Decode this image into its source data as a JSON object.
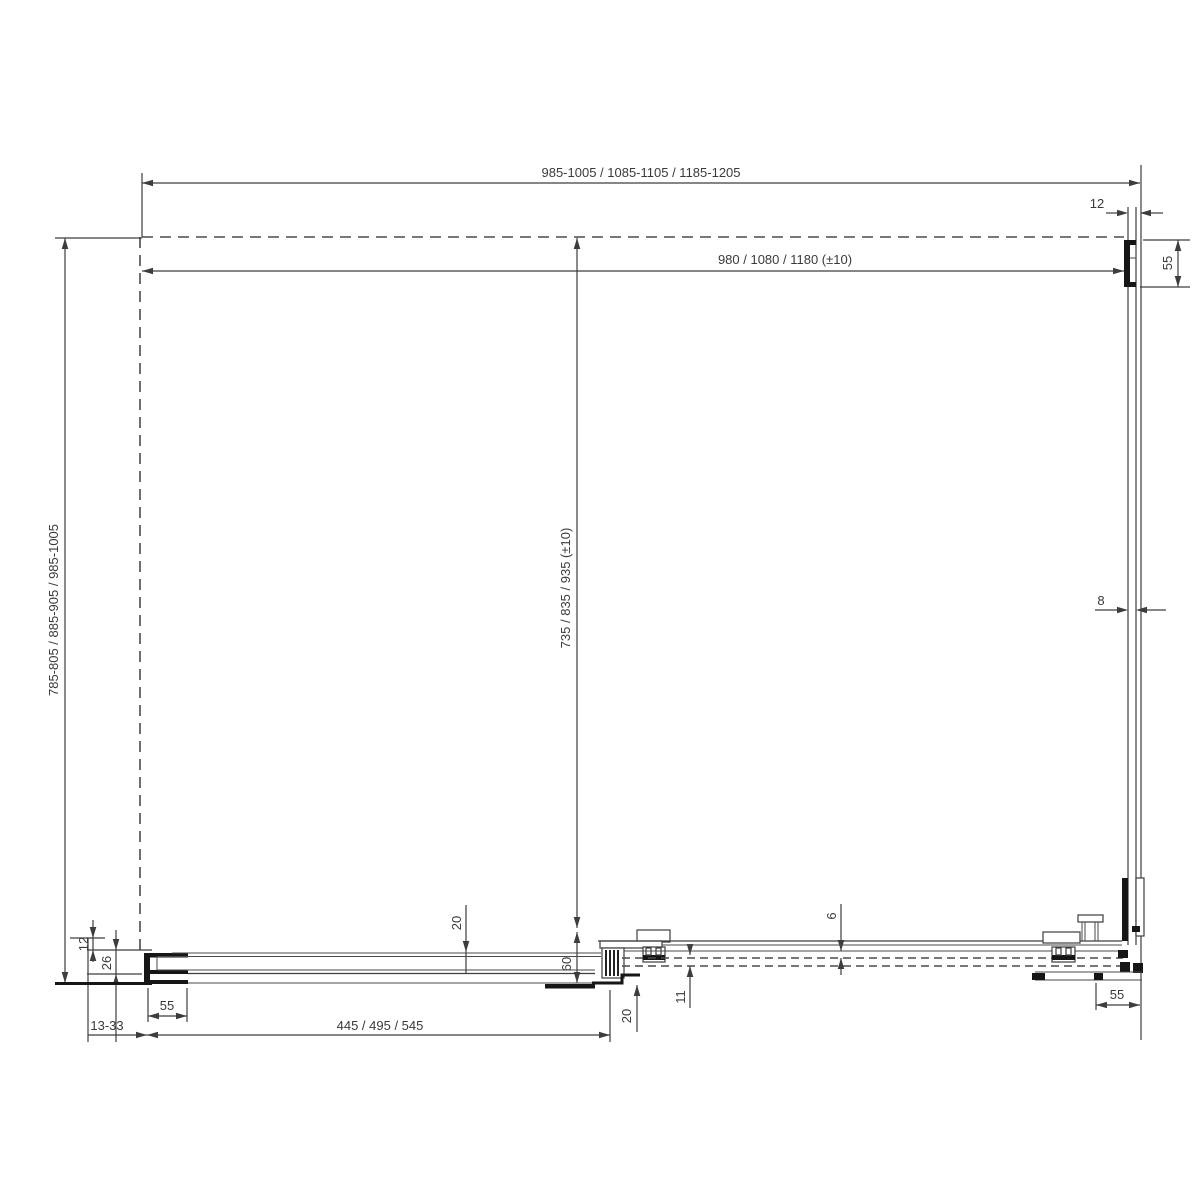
{
  "drawing_type": "technical-installation-diagram-plan-view",
  "labels": {
    "overall_width": "985-1005 / 1085-1105 / 1185-1205",
    "glass_width": "980 / 1080 / 1180 (±10)",
    "overall_depth": "785-805 / 885-905 / 985-1005",
    "door_depth": "735 / 835 / 935 (±10)",
    "fixed_segment_width": "445 / 495 / 545",
    "wall_profile_adjust_range": "13-33",
    "top_right_offset": "12",
    "wall_profile_depth_top_right": "55",
    "glass_thickness": "8",
    "rail_depth": "60",
    "rail_door_gap": "6",
    "door_glass_gap": "11",
    "glass_overlap_top": "20",
    "glass_overlap_bottom": "20",
    "left_offset_12": "12",
    "left_offset_26": "26",
    "wall_profile_width_left": "55",
    "wall_profile_width_right": "55"
  },
  "colors": {
    "line": "#3d3d3d",
    "profile_fill": "#161616",
    "background": "#ffffff",
    "dashed_line": "#4a4a4a"
  }
}
